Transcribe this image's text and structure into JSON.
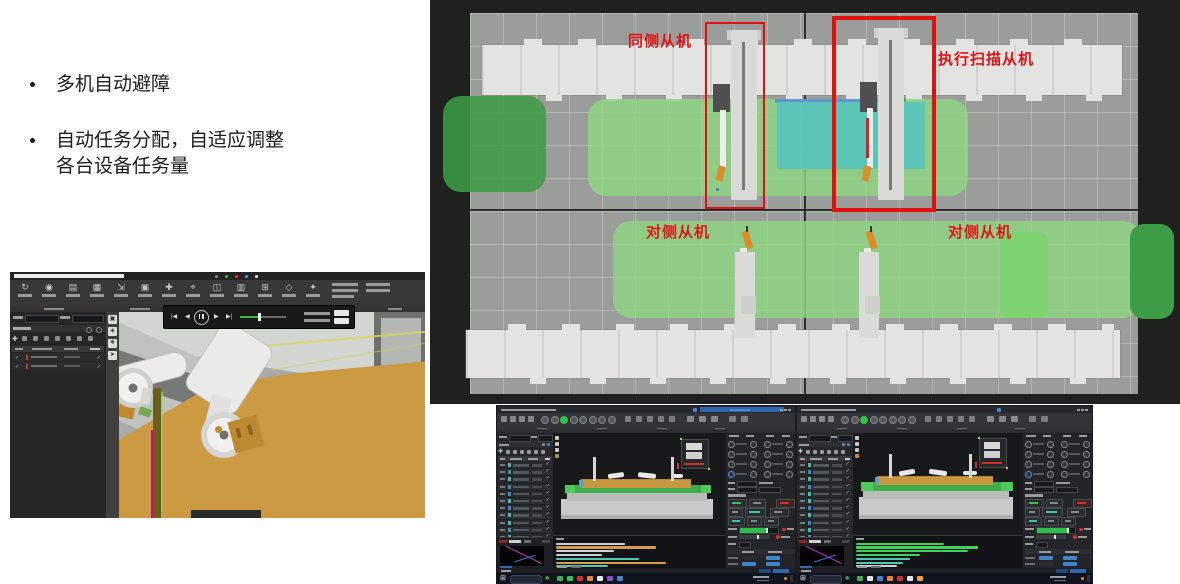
{
  "slide": {
    "bullets": {
      "b1": "多机自动避障",
      "b2_line1": "自动任务分配，自适应调整",
      "b2_line2": "各台设备任务量"
    }
  },
  "simulation": {
    "annotations": {
      "same_side": "同侧从机",
      "scan_exec": "执行扫描从机",
      "opposite_1": "对侧从机",
      "opposite_2": "对侧从机"
    },
    "colors": {
      "annotation_red": "#e01417",
      "highlight_box_red": "#e01111",
      "zone_green_light": "#8fd584",
      "zone_green_bright": "#7cd36f",
      "zone_green_dark": "#3d9c46",
      "zone_teal": "#57c4bc",
      "zone_blue_strip": "#5c8fd6",
      "background": "#1f201f",
      "grid_gray": "#9b9d9a",
      "rail_gray": "#e3e3e1",
      "robot_orange": "#d98e2b",
      "scan_beam_red": "#e02020"
    }
  },
  "sim3d_app": {
    "toolbar_icon_names": [
      "open-icon",
      "sync-icon",
      "import-icon",
      "export-icon",
      "measure-icon",
      "grid-icon",
      "layers-icon",
      "cut-icon",
      "path-icon",
      "scan-icon",
      "settings-icon",
      "view-icon",
      "help-icon"
    ],
    "toolbar_glyphs": [
      "↻",
      "◉",
      "▤",
      "▦",
      "⇲",
      "▣",
      "✚",
      "⌖",
      "◫",
      "▥",
      "⊞",
      "◇",
      "✦"
    ],
    "strip_glyphs": [
      "▣",
      "◈",
      "✥",
      "➤"
    ],
    "playback": {
      "icon_names": [
        "skip-back-icon",
        "step-back-icon",
        "pause-icon",
        "step-forward-icon",
        "skip-forward-icon"
      ],
      "skip_back": "|◀",
      "step_back": "◀",
      "step_forward": "▶",
      "skip_forward": "▶|",
      "progress_pct": 42,
      "accent_green": "#3dba4e"
    },
    "viewport_colors": {
      "ground_orange": "#cc9a42",
      "machine_gray_light": "#d3d5d2",
      "machine_gray_dark": "#777976",
      "seam_magenta": "#e5007e",
      "path_yellow": "#d8d85a"
    }
  },
  "monitor": {
    "accent": {
      "record_green": "#35c24a",
      "alert_red": "#d03030",
      "cell_blue": "#3f86c8",
      "pill_teal": "#3fbfae",
      "pill_blue": "#3f86c8",
      "title_blue": "#2f66ad",
      "progress_green": "#2fbf4f",
      "taskbar_plant_green": "#3fae4a"
    },
    "taskbar": {
      "start_glyph": "⊞",
      "plant_glyph": "♣"
    },
    "left_window": {
      "toolbar_circles": {
        "count": 8,
        "green_index": 2
      },
      "table_pills": [
        "#3fbfae",
        "#3f86c8",
        "#3fbfae",
        "#3f86c8",
        "#3f86c8",
        "#3fbfae",
        "#3f86c8",
        "#3fbfae",
        "#3fbfae",
        "#3f86c8",
        "#3fbfae",
        "#3f86c8",
        "#3fbfae",
        "#3f86c8",
        "#3fbfae"
      ],
      "console_lines": [
        {
          "w": 40,
          "c": "#cfcfcf"
        },
        {
          "w": 58,
          "c": "#d79b4a"
        },
        {
          "w": 34,
          "c": "#cfcfcf"
        },
        {
          "w": 27,
          "c": "#cfcfcf"
        },
        {
          "w": 48,
          "c": "#4ec9b0"
        },
        {
          "w": 64,
          "c": "#d79b4a"
        },
        {
          "w": 30,
          "c": "#4ec9b0"
        }
      ],
      "cell_table": [
        [
          "#2a2c2f",
          "#3f86c8"
        ],
        [
          "#3f86c8",
          "#3f86c8"
        ],
        [
          "#2a2c2f",
          "#3f86c8"
        ],
        [
          "#3f86c8",
          "#3f86c8"
        ],
        [
          "#3f86c8",
          "#3f86c8"
        ],
        [
          "#2a2c2f",
          "#2a2c2f"
        ],
        [
          "#2a2c2f",
          "#2a2c2f"
        ]
      ],
      "taskbar_icons": [
        "#3fae4a",
        "#35c24a",
        "#d03030",
        "#e8863a",
        "#e8e8e8",
        "#8a4fc9",
        "#3f86c8"
      ]
    },
    "right_window": {
      "toolbar_circles": {
        "count": 8,
        "green_index": 2
      },
      "table_pills": [
        "#3fbfae",
        "#3f86c8",
        "#3fbfae",
        "#3f86c8",
        "#3fbfae",
        "#3fbfae",
        "#3f86c8",
        "#3fbfae",
        "#3f86c8",
        "#3fbfae",
        "#3f86c8",
        "#3fbfae",
        "#3f86c8",
        "#3fbfae",
        "#3f86c8"
      ],
      "console_lines": [
        {
          "w": 52,
          "c": "#3fd158"
        },
        {
          "w": 72,
          "c": "#3fd158"
        },
        {
          "w": 66,
          "c": "#3fd158"
        },
        {
          "w": 38,
          "c": "#3fd158"
        },
        {
          "w": 32,
          "c": "#4ec9b0"
        },
        {
          "w": 28,
          "c": "#4ec9b0"
        },
        {
          "w": 24,
          "c": "#cfcfcf"
        }
      ],
      "cell_table": [
        [
          "#3f86c8",
          "#3f86c8"
        ],
        [
          "#2a2c2f",
          "#3f86c8"
        ],
        [
          "#3f86c8",
          "#3f86c8"
        ],
        [
          "#3f86c8",
          "#2a2c2f"
        ],
        [
          "#3f86c8",
          "#3f86c8"
        ],
        [
          "#2a2c2f",
          "#2a2c2f"
        ],
        [
          "#2a2c2f",
          "#2a2c2f"
        ]
      ],
      "taskbar_icons": [
        "#3fae4a",
        "#e8e8e8",
        "#3f86c8",
        "#e8863a",
        "#d03030",
        "#e8e8e8",
        "#f0a030"
      ]
    }
  }
}
